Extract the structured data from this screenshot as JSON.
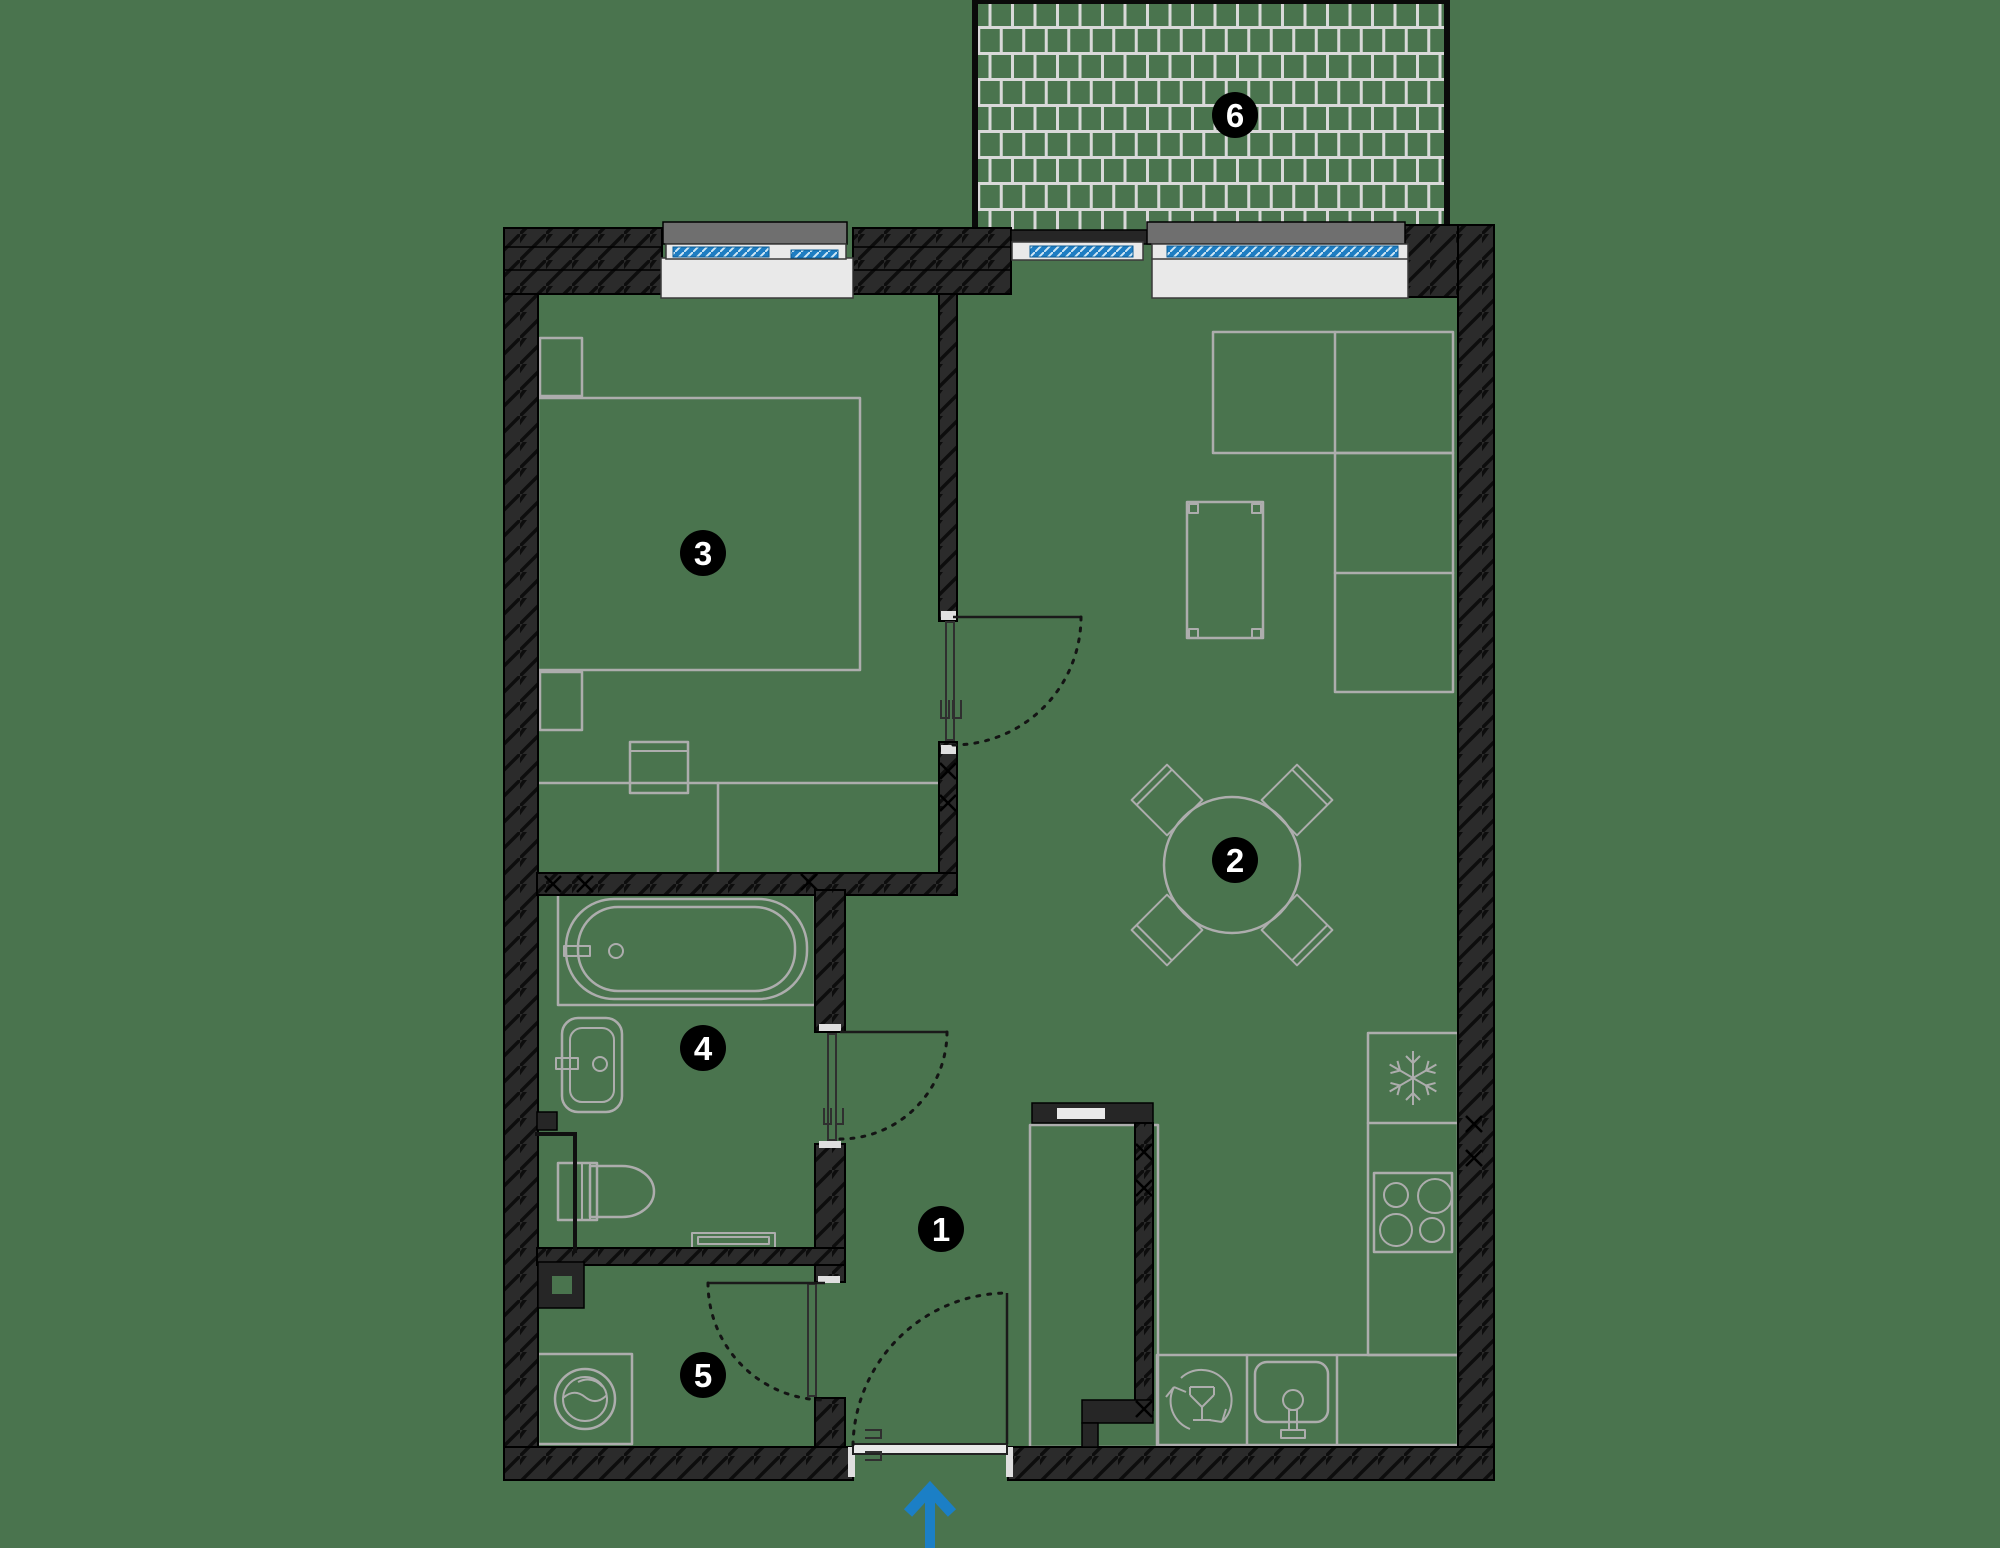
{
  "plan": {
    "type": "apartment-floor-plan",
    "room_markers": [
      {
        "number": "1"
      },
      {
        "number": "2"
      },
      {
        "number": "3"
      },
      {
        "number": "4"
      },
      {
        "number": "5"
      },
      {
        "number": "6"
      }
    ],
    "icons": {
      "fridge": "snowflake-icon",
      "stove": "four-burners-icon",
      "dishwasher": "dishwasher-cycle-glass-icon",
      "kitchen_sink": "sink-basin-icon",
      "washing_machine": "washing-machine-drum-icon",
      "entry": "entry-arrow-icon"
    },
    "colors": {
      "background": "#4A744E",
      "wall_fill": "#2B2B2B",
      "wall_line": "#000000",
      "furniture_line": "#ADADAD",
      "sill_white": "#E9E9E9",
      "window_glass": "#1E7DC2",
      "window_header": "#6F6F6F",
      "entry_arrow": "#1B7FC6",
      "badge_fill": "#000000",
      "badge_text": "#FFFFFF",
      "brick_grout": "#D9D9D9"
    }
  }
}
